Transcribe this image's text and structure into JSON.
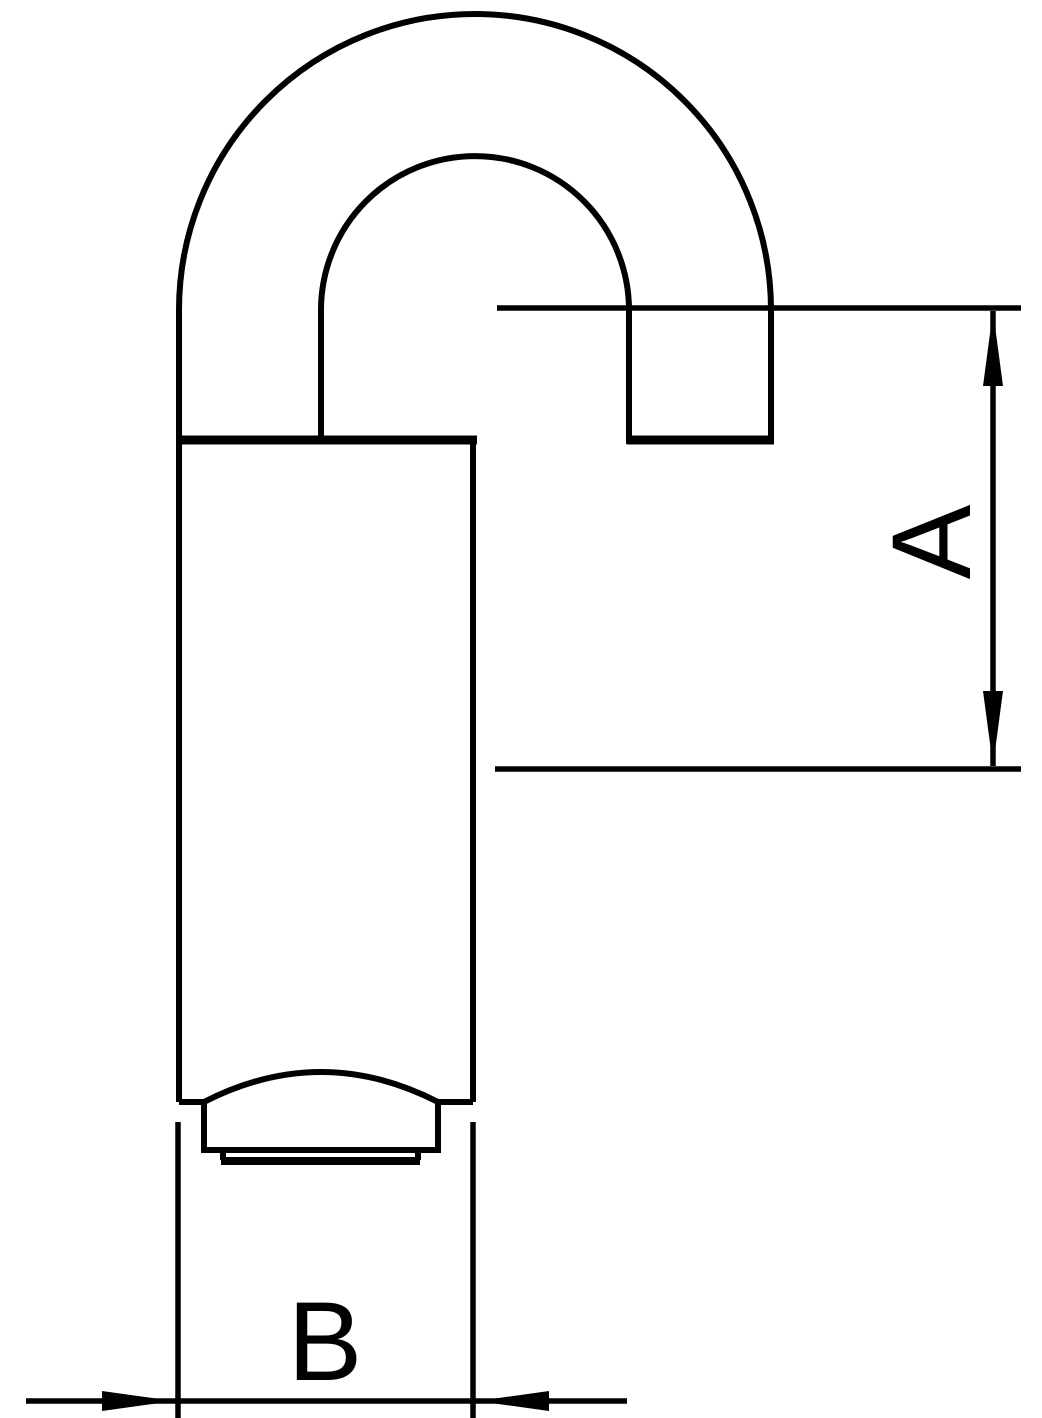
{
  "canvas": {
    "width": 1042,
    "height": 1418,
    "background_color": "#ffffff",
    "line_color": "#000000"
  },
  "drawing": {
    "kind": "technical-line-drawing",
    "dimension_labels": {
      "a": "A",
      "b": "B"
    }
  }
}
